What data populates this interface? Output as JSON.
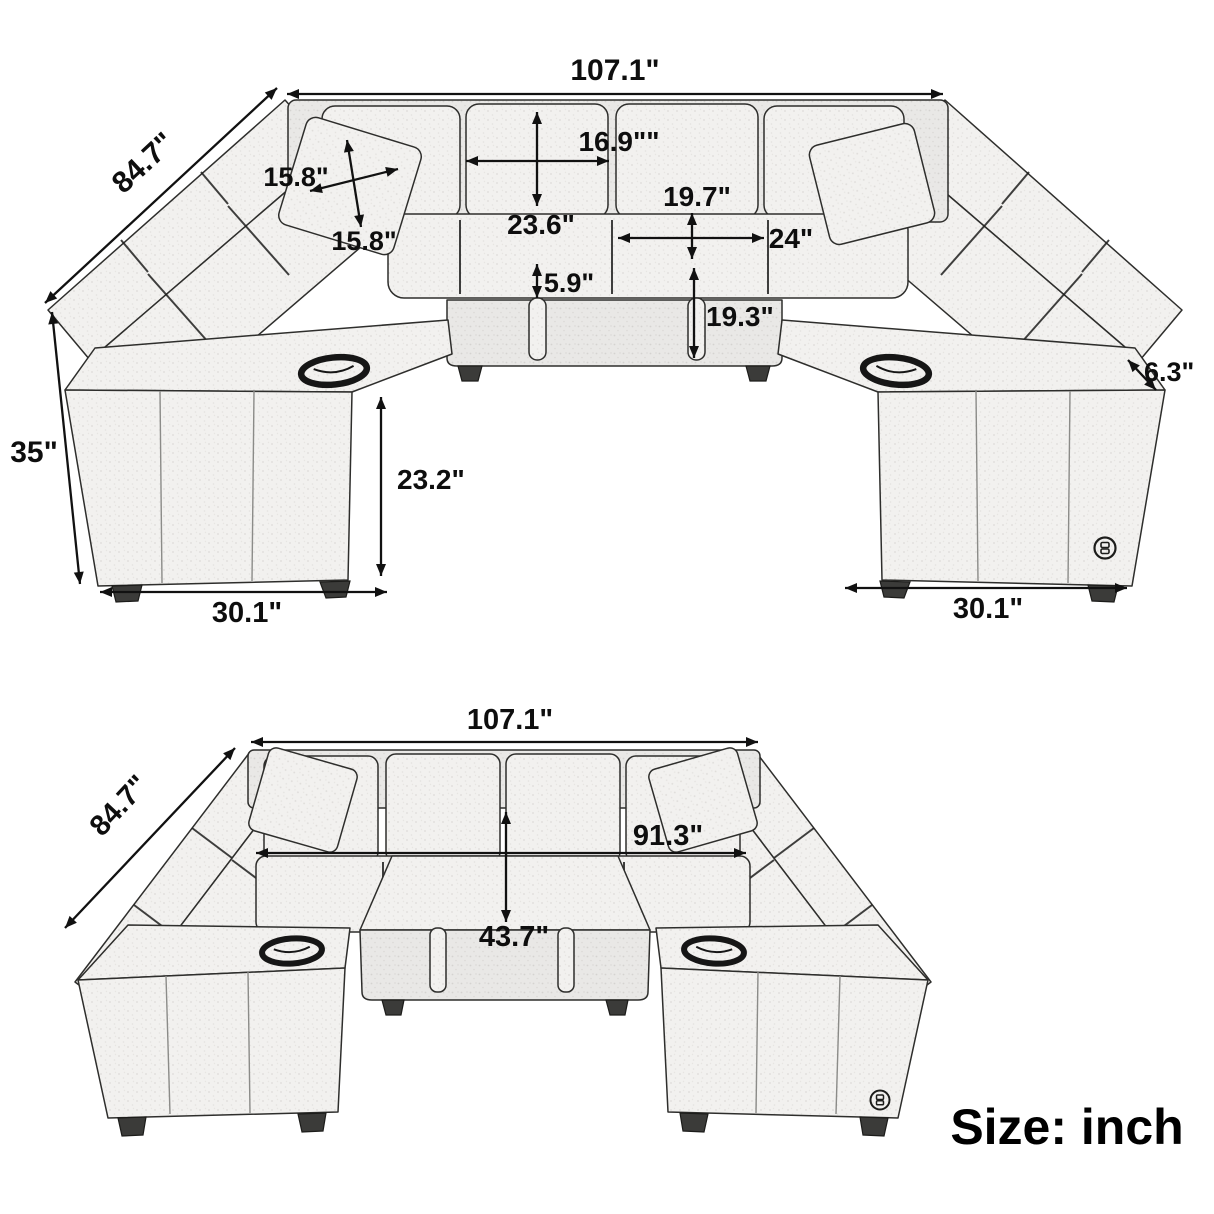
{
  "note": {
    "units": "Size: inch"
  },
  "top_view": {
    "dimensions": {
      "overall_width": "107.1\"",
      "overall_depth": "84.7\"",
      "overall_height": "35\"",
      "pillow_width": "15.8\"",
      "pillow_height": "15.8\"",
      "back_cushion_width": "16.9\"\"",
      "backrest_height": "23.6\"",
      "seat_depth": "19.7\"",
      "seat_width": "24\"",
      "seat_cushion_thickness": "5.9\"",
      "ottoman_height": "19.3\"",
      "armrest_width": "6.3\"",
      "armrest_height": "23.2\"",
      "left_arm_depth": "30.1\"",
      "right_arm_depth": "30.1\""
    }
  },
  "bottom_view": {
    "dimensions": {
      "overall_width": "107.1\"",
      "overall_depth": "84.7\"",
      "interior_width": "91.3\"",
      "interior_depth": "43.7\""
    }
  }
}
